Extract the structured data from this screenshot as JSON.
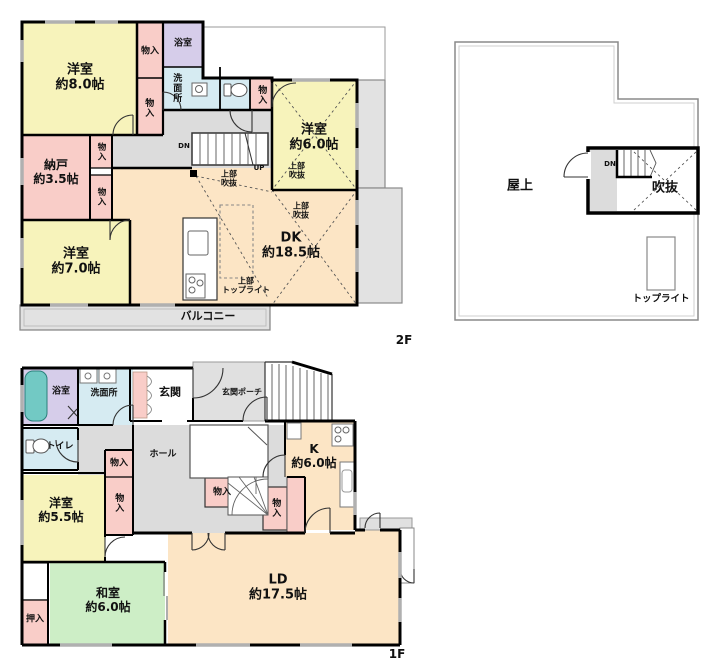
{
  "floor2": {
    "tag": "2F",
    "rooms": {
      "yoshitsu8": {
        "name": "洋室",
        "size": "約8.0帖"
      },
      "nando": {
        "name": "納戸",
        "size": "約3.5帖"
      },
      "yoshitsu7": {
        "name": "洋室",
        "size": "約7.0帖"
      },
      "yoshitsu6": {
        "name": "洋室",
        "size": "約6.0帖"
      },
      "dk": {
        "name": "DK",
        "size": "約18.5帖"
      }
    },
    "labels": {
      "monoiri": "物入",
      "yokushitsu": "浴室",
      "senmenjo": "洗面所",
      "balcony": "バルコニー",
      "jobu": "上部",
      "fukinuke": "吹抜",
      "toplight": "トップライト",
      "dn": "DN",
      "up": "UP"
    }
  },
  "roof": {
    "okujo": "屋上",
    "fukinuke": "吹抜",
    "dn": "DN",
    "toplight": "トップライト"
  },
  "floor1": {
    "tag": "1F",
    "rooms": {
      "yoshitsu55": {
        "name": "洋室",
        "size": "約5.5帖"
      },
      "washitsu": {
        "name": "和室",
        "size": "約6.0帖"
      },
      "ld": {
        "name": "LD",
        "size": "約17.5帖"
      },
      "k": {
        "name": "K",
        "size": "約6.0帖"
      }
    },
    "labels": {
      "yokushitsu": "浴室",
      "senmenjo": "洗面所",
      "genkan": "玄関",
      "porch": "玄関ポーチ",
      "toire": "トイレ",
      "hall": "ホール",
      "monoiri": "物入",
      "oshiire": "押入"
    }
  },
  "colors": {
    "room_yellow": "#f7f3bb",
    "closet_pink": "#f9cdc8",
    "bath_lavender": "#d6cdea",
    "water_blue": "#d6ebf2",
    "tub_teal": "#72c9c4",
    "dk_peach": "#fce5c5",
    "tatami_green": "#cdeec6",
    "hall_gray": "#dcdcdc",
    "balcony_gray": "#e2e2e2",
    "wall_black": "#000000"
  }
}
